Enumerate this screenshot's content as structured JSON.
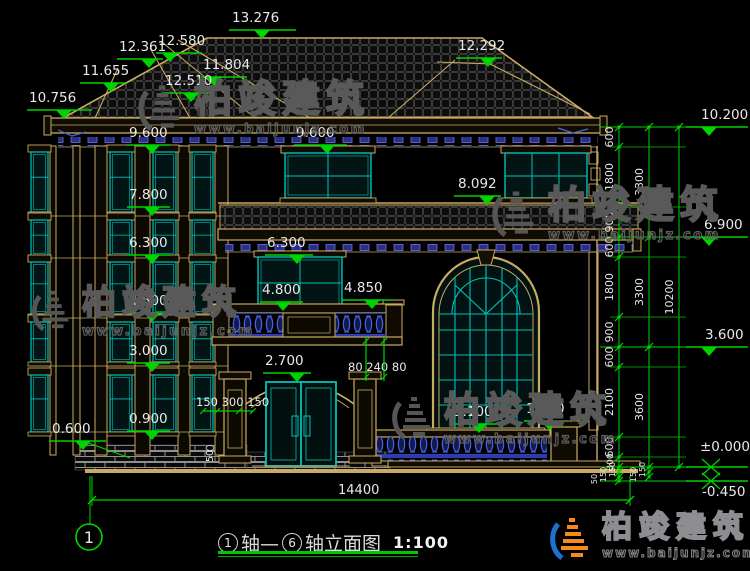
{
  "watermark": {
    "brand": "柏竣建筑",
    "url": "www.baijunjz.com"
  },
  "colors": {
    "line_tan": "#c9ab61",
    "dim_green": "#00d400",
    "glass_teal": "#00c2b8",
    "baluster_blue": "#4d62e8",
    "text_white": "#e8e8e8"
  },
  "drawing": {
    "axis_bubble": "1",
    "title": {
      "axis_start": "1",
      "axis_start_suffix": "轴—",
      "axis_end": "6",
      "axis_end_suffix": "轴立面图",
      "scale": "1:100"
    },
    "dims": {
      "overall_width": "14400",
      "entrance_left": "150 300 150",
      "entrance_right": "80 240 80",
      "step": "50"
    },
    "elevation_markers": [
      {
        "label": "13.276",
        "tx": 232,
        "ty": 22,
        "x1": 229,
        "x2": 296,
        "y": 30,
        "tri": 262
      },
      {
        "label": "12.580",
        "tx": 158,
        "ty": 45,
        "x1": 156,
        "x2": 202,
        "y": 53,
        "tri": 170
      },
      {
        "label": "12.361",
        "tx": 119,
        "ty": 51,
        "x1": 117,
        "x2": 163,
        "y": 59,
        "tri": 149
      },
      {
        "label": "11.804",
        "tx": 203,
        "ty": 69,
        "x1": 201,
        "x2": 247,
        "y": 77,
        "tri": 214
      },
      {
        "label": "12.510",
        "tx": 165,
        "ty": 85,
        "x1": 163,
        "x2": 209,
        "y": 93,
        "tri": 191
      },
      {
        "label": "11.655",
        "tx": 82,
        "ty": 75,
        "x1": 80,
        "x2": 126,
        "y": 83,
        "tri": 111
      },
      {
        "label": "10.756",
        "tx": 29,
        "ty": 102,
        "x1": 27,
        "x2": 92,
        "y": 110,
        "tri": 64
      },
      {
        "label": "12.292",
        "tx": 458,
        "ty": 50,
        "x1": 456,
        "x2": 502,
        "y": 58,
        "tri": 488
      },
      {
        "label": "9.600",
        "tx": 129,
        "ty": 137,
        "x1": 127,
        "x2": 170,
        "y": 145,
        "tri": 152
      },
      {
        "label": "9.600",
        "tx": 296,
        "ty": 137,
        "x1": 294,
        "x2": 347,
        "y": 145,
        "tri": 327
      },
      {
        "label": "8.092",
        "tx": 458,
        "ty": 188,
        "x1": 454,
        "x2": 501,
        "y": 196,
        "tri": 487
      },
      {
        "label": "7.800",
        "tx": 129,
        "ty": 199,
        "x1": 127,
        "x2": 170,
        "y": 207,
        "tri": 152
      },
      {
        "label": "6.300",
        "tx": 129,
        "ty": 247,
        "x1": 127,
        "x2": 170,
        "y": 255,
        "tri": 152
      },
      {
        "label": "6.300",
        "tx": 267,
        "ty": 247,
        "x1": 265,
        "x2": 313,
        "y": 255,
        "tri": 297
      },
      {
        "label": "4.800",
        "tx": 262,
        "ty": 294,
        "x1": 260,
        "x2": 303,
        "y": 302,
        "tri": 283
      },
      {
        "label": "4.850",
        "tx": 344,
        "ty": 292,
        "x1": 342,
        "x2": 391,
        "y": 300,
        "tri": 372
      },
      {
        "label": "4.500",
        "tx": 129,
        "ty": 305,
        "x1": 127,
        "x2": 170,
        "y": 313,
        "tri": 152
      },
      {
        "label": "3.000",
        "tx": 129,
        "ty": 355,
        "x1": 127,
        "x2": 170,
        "y": 363,
        "tri": 152
      },
      {
        "label": "2.700",
        "tx": 265,
        "ty": 365,
        "x1": 263,
        "x2": 311,
        "y": 373,
        "tri": 297
      },
      {
        "label": "1.100",
        "tx": 454,
        "ty": 416,
        "x1": 452,
        "x2": 499,
        "y": 424,
        "tri": 479
      },
      {
        "label": "1.250",
        "tx": 526,
        "ty": 413,
        "x1": 524,
        "x2": 566,
        "y": 421,
        "tri": 549
      },
      {
        "label": "0.900",
        "tx": 129,
        "ty": 423,
        "x1": 127,
        "x2": 170,
        "y": 431,
        "tri": 152
      },
      {
        "label": "0.600",
        "tx": 52,
        "ty": 433,
        "x1": 49,
        "x2": 106,
        "y": 441,
        "tri": 83,
        "leader": [
          83,
          441,
          130,
          458
        ]
      },
      {
        "label": "10.200",
        "tx": 701,
        "ty": 119,
        "x1": 686,
        "x2": 748,
        "y": 127,
        "tri": 709
      },
      {
        "label": "6.900",
        "tx": 704,
        "ty": 229,
        "x1": 686,
        "x2": 748,
        "y": 237,
        "tri": 709
      },
      {
        "label": "3.600",
        "tx": 705,
        "ty": 339,
        "x1": 686,
        "x2": 748,
        "y": 347,
        "tri": 709
      },
      {
        "label": "±0.000",
        "tx": 700,
        "ty": 451,
        "x1": 686,
        "x2": 748,
        "y": 467,
        "tri": 711,
        "style": "x"
      },
      {
        "label": "-0.450",
        "tx": 702,
        "ty": 496,
        "x1": 686,
        "x2": 748,
        "y": 481,
        "tri": 711,
        "style": "x"
      }
    ],
    "right_dim_chains": {
      "levels_major": [
        127,
        237,
        347,
        467,
        481
      ],
      "levels_minor": [
        147,
        207,
        257,
        317,
        367,
        437,
        457
      ],
      "chains": [
        {
          "x": 619,
          "segs": [
            {
              "label": "600",
              "y1": 127,
              "y2": 147
            },
            {
              "label": "1800",
              "y1": 147,
              "y2": 207
            },
            {
              "label": "900",
              "y1": 207,
              "y2": 237
            },
            {
              "label": "600",
              "y1": 237,
              "y2": 257
            },
            {
              "label": "1800",
              "y1": 257,
              "y2": 317
            },
            {
              "label": "900",
              "y1": 317,
              "y2": 347
            },
            {
              "label": "600",
              "y1": 347,
              "y2": 367
            },
            {
              "label": "2100",
              "y1": 367,
              "y2": 437
            },
            {
              "label": "600",
              "y1": 437,
              "y2": 457
            },
            {
              "label": "300",
              "y1": 457,
              "y2": 467,
              "fs": 9
            },
            {
              "label": "150",
              "y1": 467,
              "y2": 472,
              "fs": 8,
              "dx": -4
            },
            {
              "label": "150",
              "y1": 472,
              "y2": 477,
              "fs": 8,
              "dx": -13
            },
            {
              "label": "50",
              "y1": 477,
              "y2": 481,
              "fs": 8,
              "dx": -22
            }
          ]
        },
        {
          "x": 649,
          "segs": [
            {
              "label": "3300",
              "y1": 127,
              "y2": 237
            },
            {
              "label": "3300",
              "y1": 237,
              "y2": 347
            },
            {
              "label": "3600",
              "y1": 347,
              "y2": 467
            },
            {
              "label": "150",
              "y1": 467,
              "y2": 472,
              "fs": 8,
              "dx": -4
            },
            {
              "label": "150",
              "y1": 472,
              "y2": 477,
              "fs": 8,
              "dx": -13
            }
          ]
        },
        {
          "x": 679,
          "segs": [
            {
              "label": "10200",
              "y1": 127,
              "y2": 467
            }
          ]
        }
      ]
    }
  }
}
